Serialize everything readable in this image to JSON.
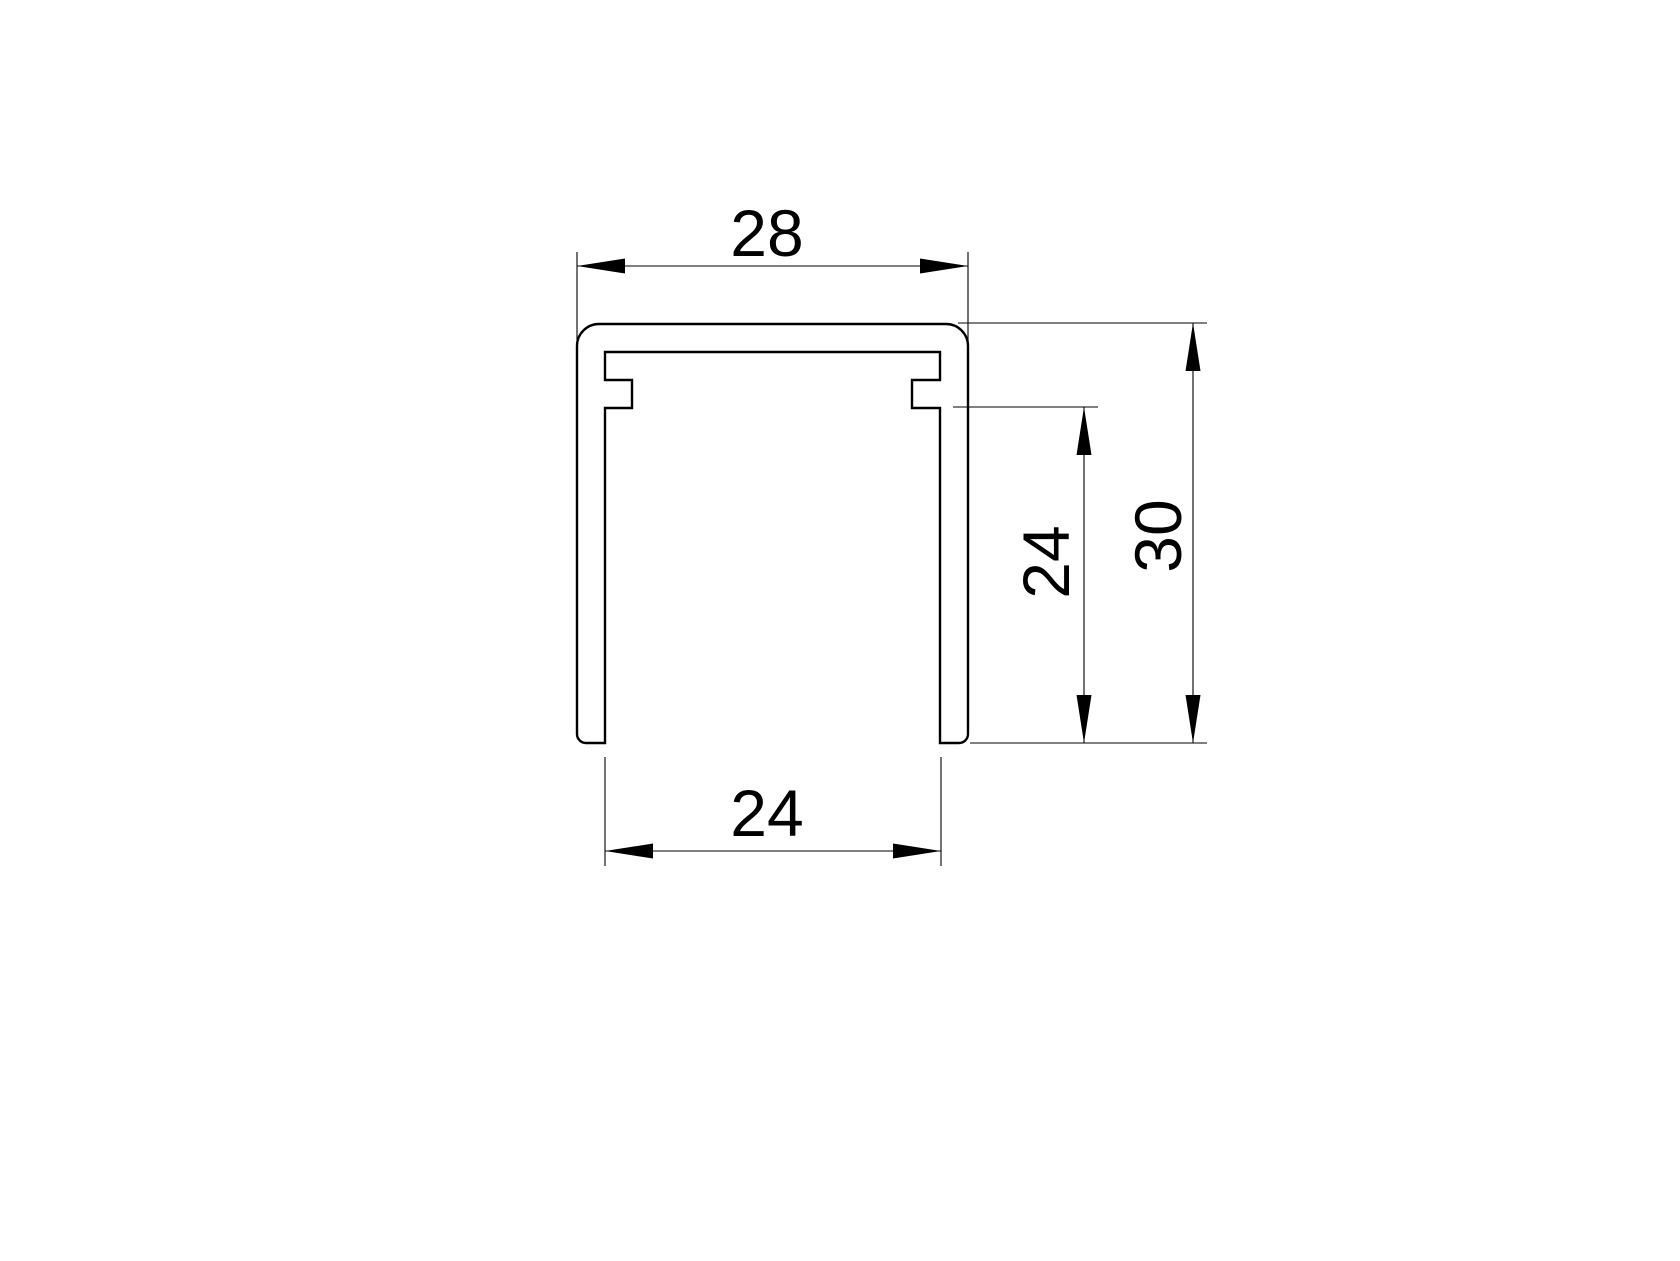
{
  "drawing": {
    "subject": "U-channel profile cross-section",
    "background_color": "#ffffff",
    "line_color": "#000000",
    "labels": {
      "outer_width": "28",
      "inner_width": "24",
      "inner_height": "24",
      "outer_height": "30"
    }
  }
}
